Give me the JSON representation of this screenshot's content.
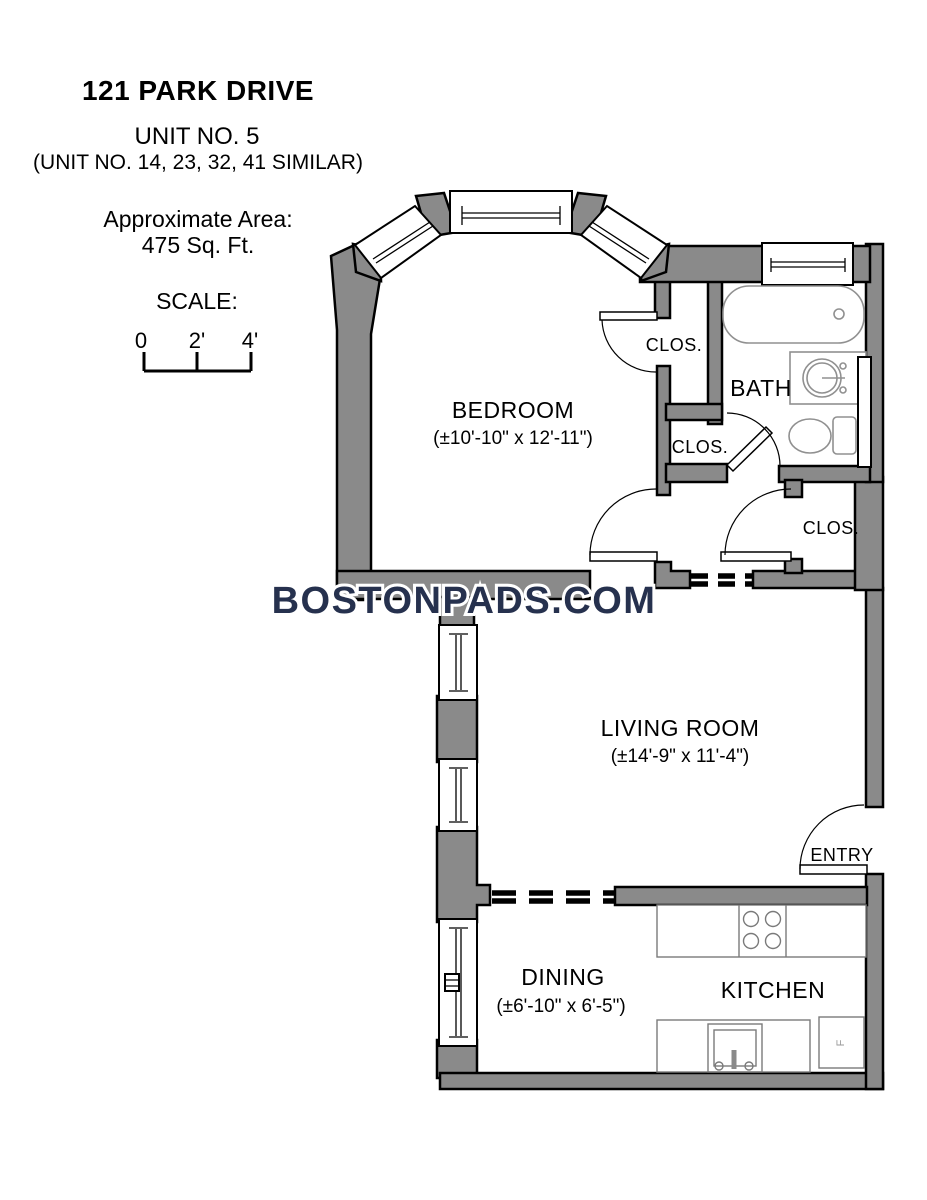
{
  "header": {
    "title": "121 PARK DRIVE",
    "unit": "UNIT NO. 5",
    "similar_units": "(UNIT NO. 14, 23, 32, 41 SIMILAR)",
    "area_label": "Approximate Area:",
    "area_value": "475 Sq. Ft."
  },
  "scale": {
    "label": "SCALE:",
    "ticks": [
      "0",
      "2'",
      "4'"
    ]
  },
  "watermark": "BOSTONPADS.COM",
  "rooms": {
    "bedroom": {
      "name": "BEDROOM",
      "dims": "(±10'-10\" x 12'-11\")"
    },
    "bath": {
      "name": "BATH"
    },
    "living_room": {
      "name": "LIVING ROOM",
      "dims": "(±14'-9\" x 11'-4\")"
    },
    "dining": {
      "name": "DINING",
      "dims": "(±6'-10\" x 6'-5\")"
    },
    "kitchen": {
      "name": "KITCHEN"
    },
    "entry": {
      "name": "ENTRY"
    },
    "closet_bedroom": {
      "name": "CLOS."
    },
    "closet_hall_small": {
      "name": "CLOS."
    },
    "closet_hall": {
      "name": "CLOS."
    }
  },
  "fixtures": {
    "fridge_label": "F"
  },
  "colors": {
    "wall_fill": "#8A8A8A",
    "outline": "#000000",
    "watermark": "#26314E",
    "fixture_stroke": "#909090"
  }
}
